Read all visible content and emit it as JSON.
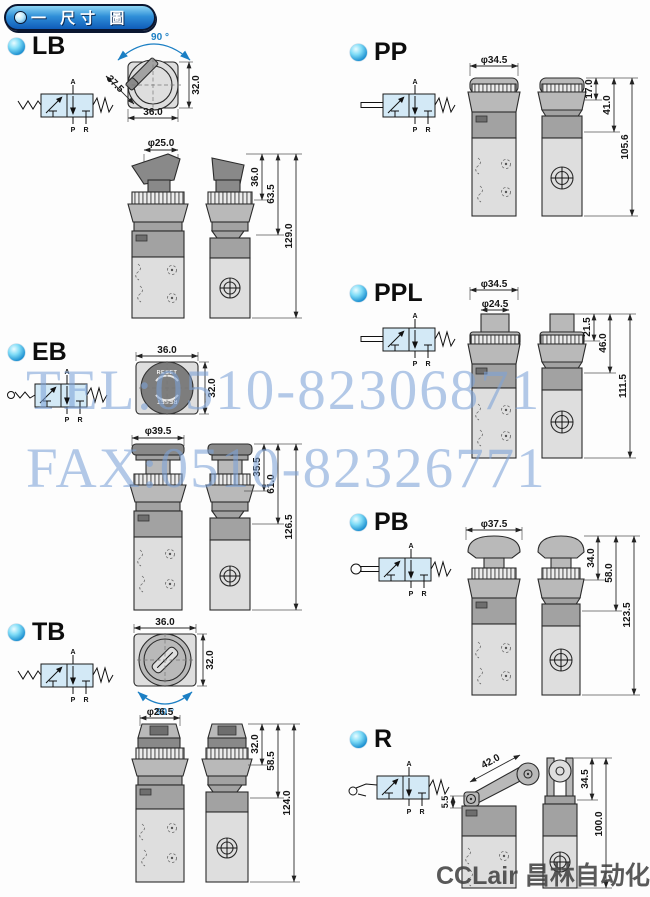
{
  "header": {
    "title": "一 尺寸 圖"
  },
  "watermark": {
    "tel": "TEL:0510-82306871",
    "fax": "FAX:0510-82326771"
  },
  "logo": {
    "text": "CCLair 昌林自动化"
  },
  "valve": {
    "port_a": "A",
    "port_p": "P",
    "port_r": "R"
  },
  "sections": {
    "LB": {
      "label": "LB",
      "angle": "90 °",
      "top_diag": "37.5",
      "top_h": "32.0",
      "top_w": "36.0",
      "knob_dia": "φ25.0",
      "dim1": "36.0",
      "dim2": "63.5",
      "dim3": "129.0"
    },
    "EB": {
      "label": "EB",
      "top_w": "36.0",
      "top_h": "32.0",
      "button_text": "RESET",
      "knob_dia": "φ39.5",
      "dim1": "35.5",
      "dim2": "61.0",
      "dim3": "126.5"
    },
    "TB": {
      "label": "TB",
      "top_w": "36.0",
      "top_h": "32.0",
      "angle": "90 °",
      "knob_dia": "φ26.5",
      "dim1": "32.0",
      "dim2": "58.5",
      "dim3": "124.0"
    },
    "PP": {
      "label": "PP",
      "cap_dia": "φ34.5",
      "dim1": "17.0",
      "dim2": "41.0",
      "dim3": "105.6"
    },
    "PPL": {
      "label": "PPL",
      "cap_dia": "φ34.5",
      "button_dia": "φ24.5",
      "dim1": "21.5",
      "dim2": "46.0",
      "dim3": "111.5"
    },
    "PB": {
      "label": "PB",
      "cap_dia": "φ37.5",
      "dim1": "34.0",
      "dim2": "58.0",
      "dim3": "123.5"
    },
    "R": {
      "label": "R",
      "lever_len": "42.0",
      "dim0": "5.5",
      "dim1": "34.5",
      "dim2": "100.0"
    }
  }
}
